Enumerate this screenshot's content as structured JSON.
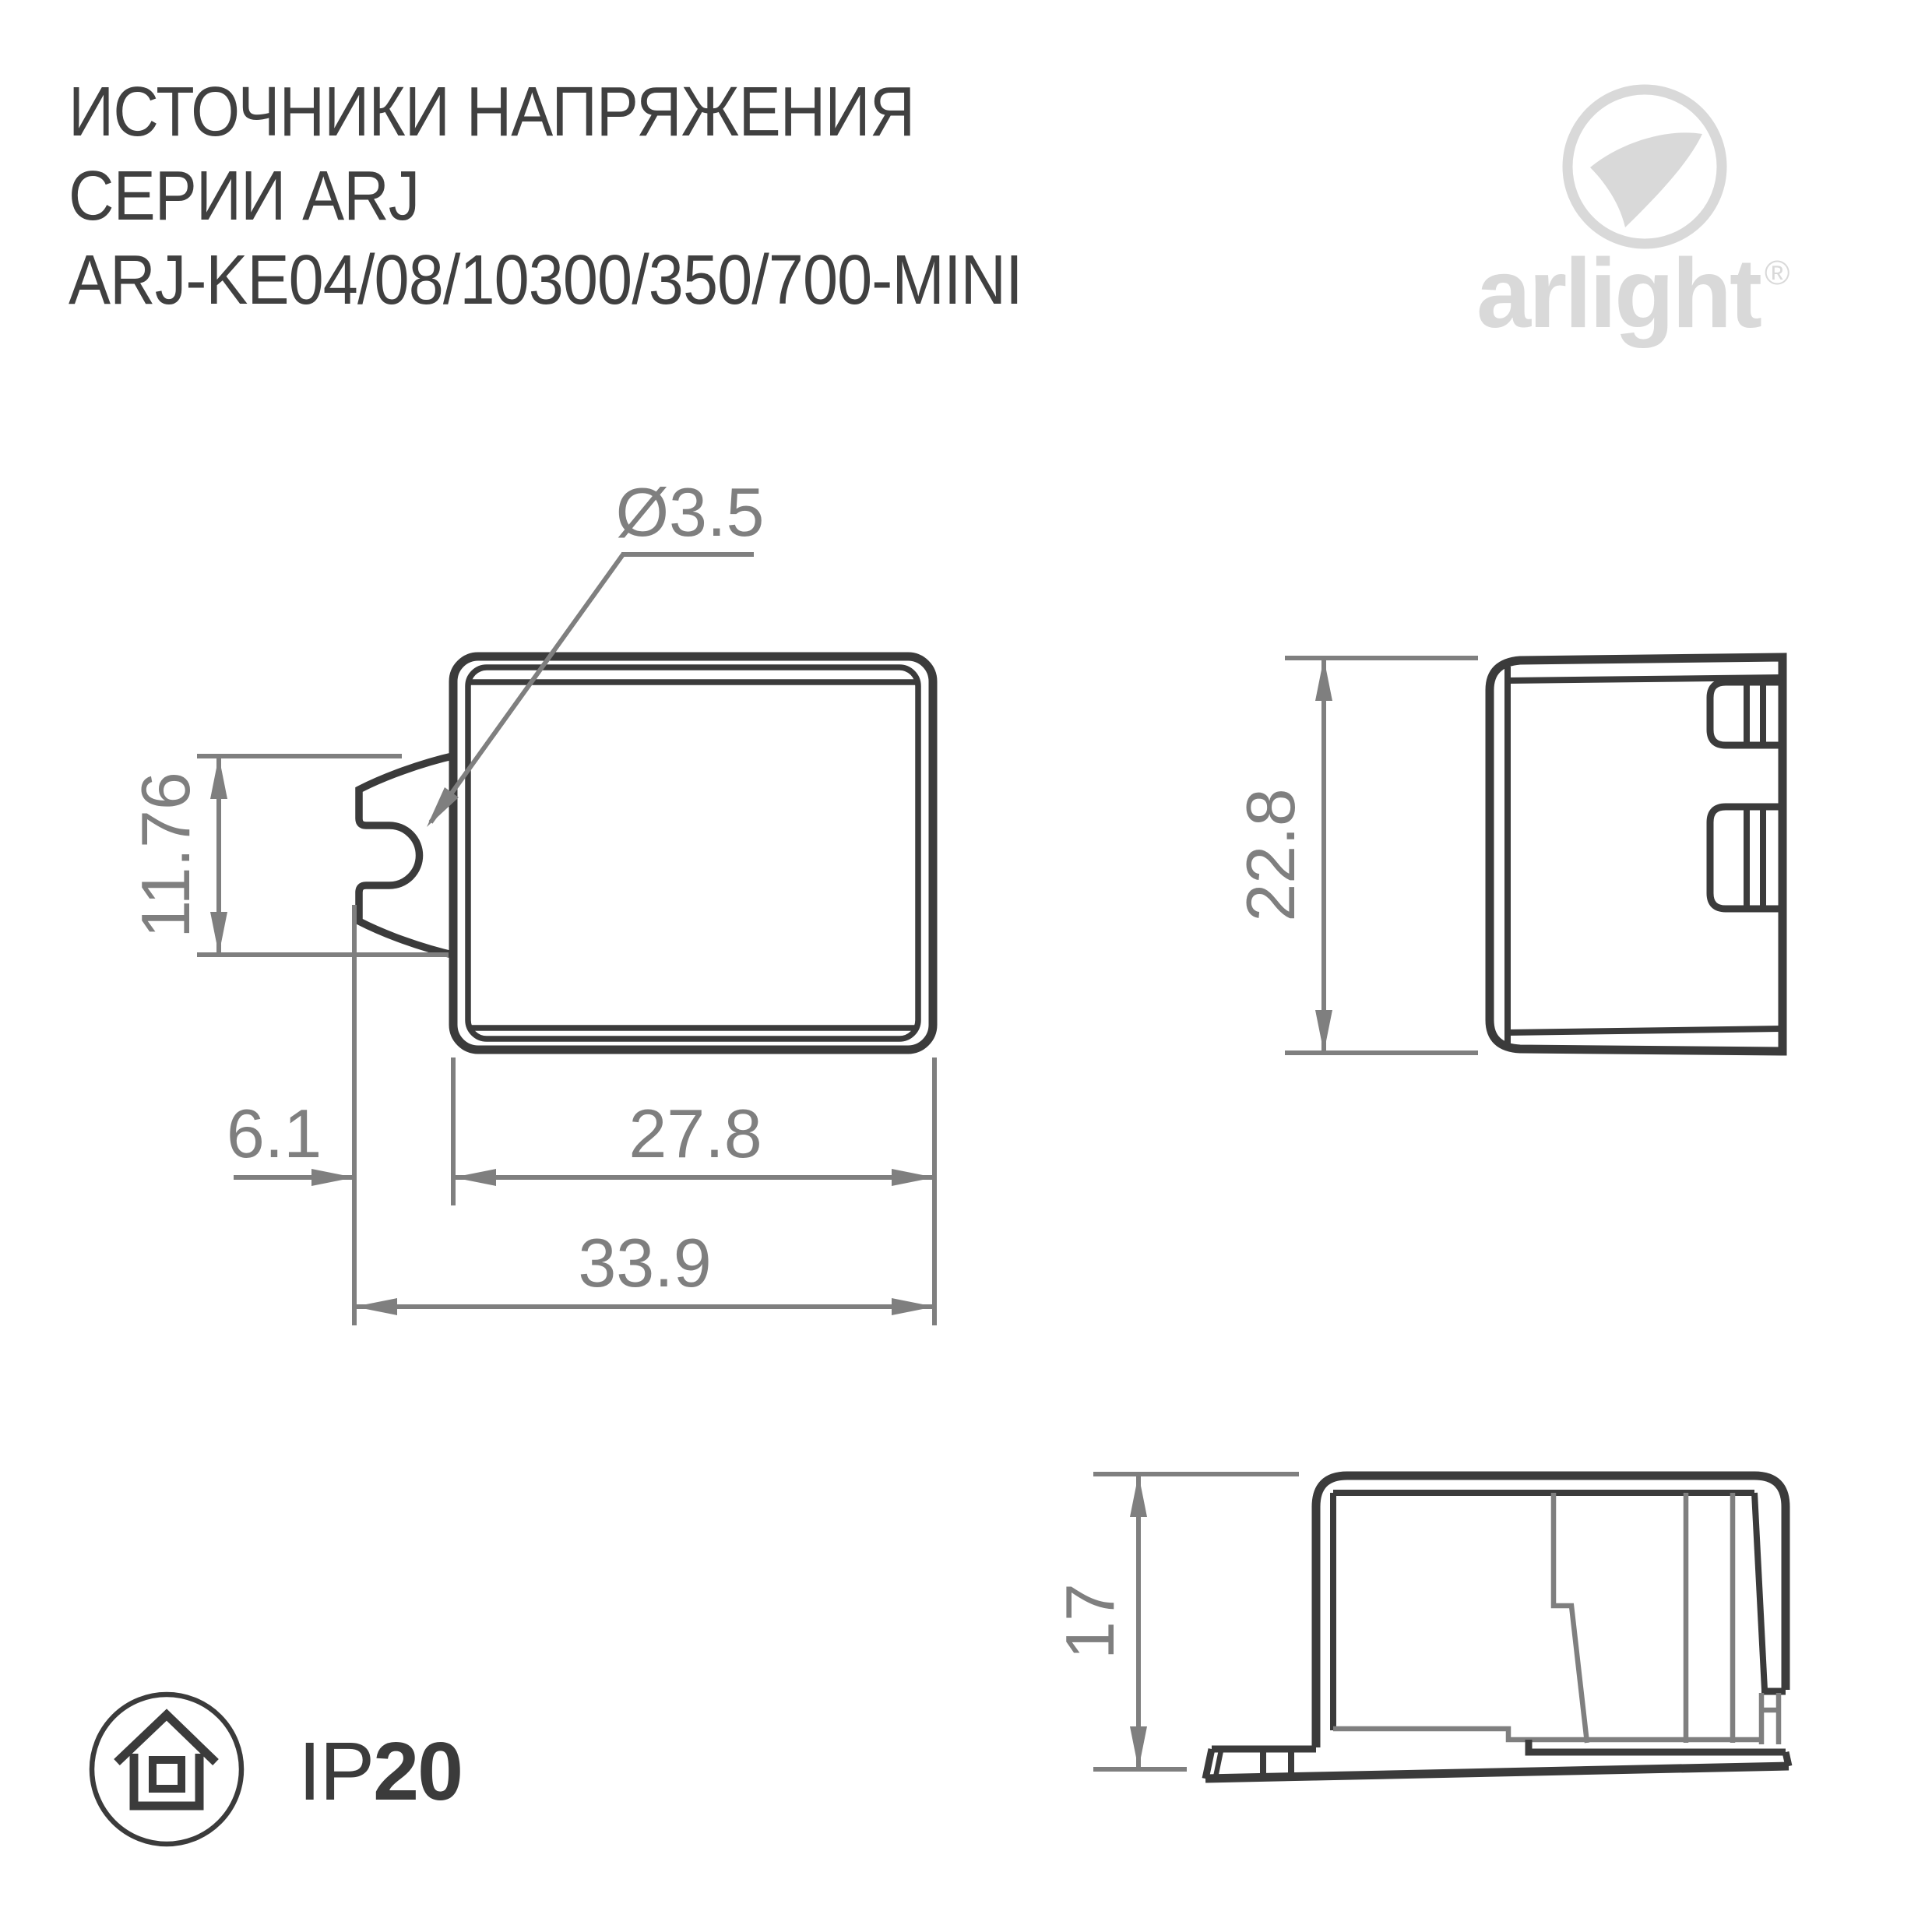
{
  "header": {
    "title_line1": "ИСТОЧНИКИ НАПРЯЖЕНИЯ",
    "title_line2": "СЕРИИ ARJ",
    "title_line3": "ARJ-KE04/08/10300/350/700-MINI"
  },
  "logo": {
    "brand": "arlight",
    "registered_mark": "®",
    "icon": "arlight-swoosh-icon"
  },
  "drawing": {
    "front_view": {
      "hole_diameter": "Ø3.5",
      "clip_height": "11.76",
      "clip_offset": "6.1",
      "body_width": "27.8",
      "overall_width": "33.9"
    },
    "side_view": {
      "body_height": "22.8"
    },
    "profile_view": {
      "body_height": "17"
    }
  },
  "footer": {
    "ip_prefix": "IP",
    "ip_value": "20",
    "icon": "indoor-protection-house-icon"
  },
  "colors": {
    "line": "#3b3b3b",
    "dimension": "#7f7f7f",
    "title_text": "#404040",
    "logo": "#d9d9d9"
  }
}
